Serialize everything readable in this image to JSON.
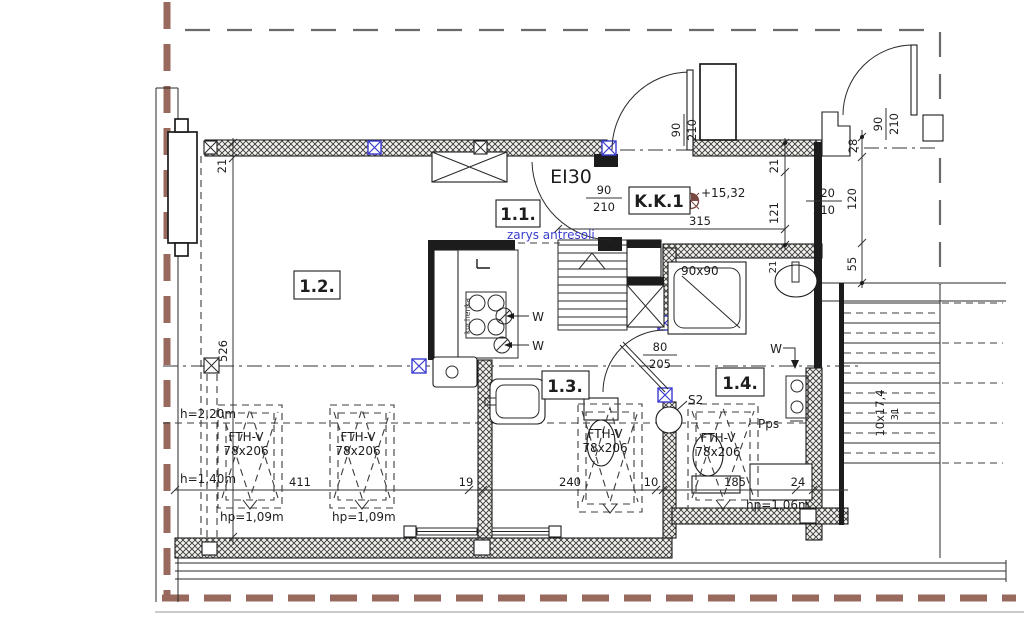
{
  "title": "Rzut antresoli - plan mieszkania",
  "rooms": {
    "r11": "1.1.",
    "r12": "1.2.",
    "r13": "1.3.",
    "r14": "1.4.",
    "kk1": "K.K.1"
  },
  "level_mark": "+15,32",
  "fire_rating": "EI30",
  "notes": {
    "mezzanine_outline": "zarys antresoli",
    "shower_size": "90x90",
    "stair_note_1": "10x17,4",
    "stair_note_2": "31",
    "s2": "S2",
    "pps": "Pps",
    "vent": "W",
    "stove": "kuchenka"
  },
  "heights": {
    "h220": "h=2,20m",
    "h140": "h=1,40m",
    "hp109": "hp=1,09m",
    "hp106": "hp=1,06m"
  },
  "window": {
    "type": "FTH-V",
    "size": "78x206"
  },
  "doors": {
    "hall_w": "90",
    "hall_h": "210",
    "entry_top_w": "90",
    "entry_top_h": "210",
    "entry_right_w": "90",
    "entry_right_h": "210",
    "bath_upper_w": "120",
    "bath_upper_h": "210",
    "bath_lower_w": "80",
    "bath_lower_h": "205"
  },
  "dims": {
    "d21a": "21",
    "d526": "526",
    "d21b": "21",
    "d121": "121",
    "d315": "315",
    "d28": "28",
    "d120": "120",
    "d55": "55",
    "d21c": "21",
    "d411": "411",
    "d19": "19",
    "d240": "240",
    "d10": "10",
    "d185": "185",
    "d24": "24"
  },
  "colors": {
    "line": "#1c1c1c",
    "boundary": "#9a695d",
    "accent_blue": "#3a3ad0",
    "level_mark": "#7a4a42"
  }
}
